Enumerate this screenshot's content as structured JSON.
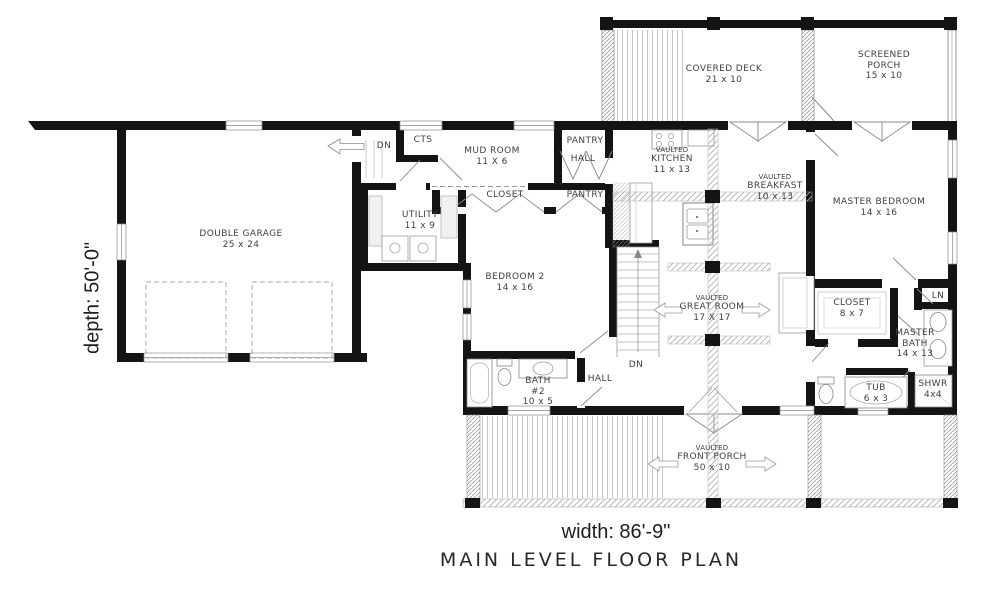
{
  "plan": {
    "title": "MAIN LEVEL FLOOR PLAN",
    "width_label": "width: 86'-9\"",
    "depth_label": "depth: 50'-0\""
  },
  "colors": {
    "wall": "#141414",
    "hatch": "#b7b7b7",
    "label_text": "#3f3f3f",
    "dimension_text": "#1e1e1e"
  },
  "rooms": {
    "covered_deck": {
      "lines": [
        "COVERED DECK",
        "21 x 10"
      ]
    },
    "screened_porch": {
      "lines": [
        "SCREENED",
        "PORCH",
        "15 x 10"
      ]
    },
    "double_garage": {
      "lines": [
        "DOUBLE GARAGE",
        "25 x 24"
      ]
    },
    "garage_dn": {
      "lines": [
        "DN"
      ]
    },
    "cts": {
      "lines": [
        "CTS"
      ]
    },
    "mud_room": {
      "lines": [
        "MUD ROOM",
        "11 X 6"
      ]
    },
    "pantry_upper": {
      "lines": [
        "PANTRY"
      ]
    },
    "hall_upper": {
      "lines": [
        "HALL"
      ]
    },
    "closet_bedroom2": {
      "lines": [
        "CLOSET"
      ]
    },
    "pantry_lower": {
      "lines": [
        "PANTRY"
      ]
    },
    "utility": {
      "lines": [
        "UTILITY",
        "11 x 9"
      ]
    },
    "kitchen": {
      "lines": [
        "VAULTED",
        "KITCHEN",
        "11 x 13"
      ]
    },
    "breakfast": {
      "lines": [
        "VAULTED",
        "BREAKFAST",
        "10 x 13"
      ]
    },
    "master_bedroom": {
      "lines": [
        "MASTER BEDROOM",
        "14 x 16"
      ]
    },
    "bedroom_2": {
      "lines": [
        "BEDROOM 2",
        "14 x 16"
      ]
    },
    "great_room": {
      "lines": [
        "VAULTED",
        "GREAT ROOM",
        "17 X 17"
      ]
    },
    "stairs_dn": {
      "lines": [
        "DN"
      ]
    },
    "master_closet": {
      "lines": [
        "CLOSET",
        "8 x 7"
      ]
    },
    "linen": {
      "lines": [
        "LN"
      ]
    },
    "master_bath": {
      "lines": [
        "MASTER",
        "BATH",
        "14 x 13"
      ]
    },
    "tub": {
      "lines": [
        "TUB",
        "6 x 3"
      ]
    },
    "shower": {
      "lines": [
        "SHWR",
        "4x4"
      ]
    },
    "bath_2": {
      "lines": [
        "BATH",
        "#2",
        "10 x 5"
      ]
    },
    "hall_lower": {
      "lines": [
        "HALL"
      ]
    },
    "front_porch": {
      "lines": [
        "VAULTED",
        "FRONT PORCH",
        "50 x 10"
      ]
    }
  }
}
